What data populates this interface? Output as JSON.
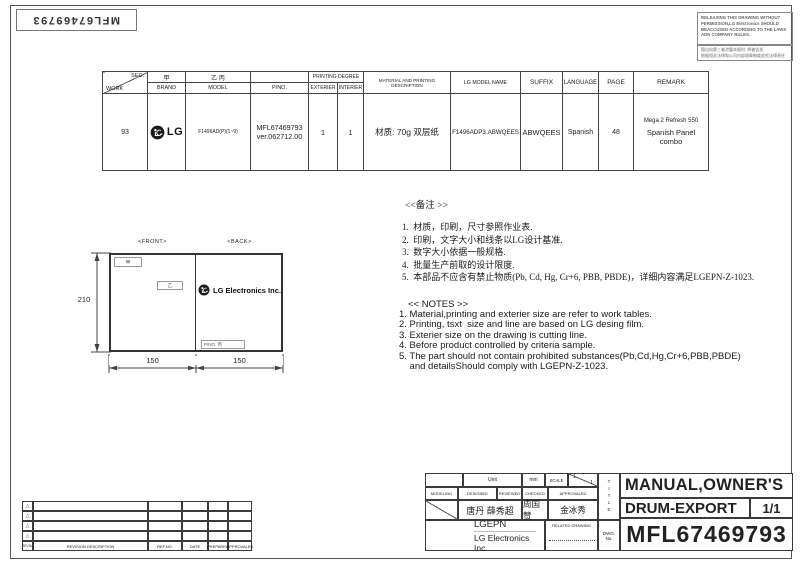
{
  "page": {
    "doc_number_rotated": "MFL67469793",
    "release_warning_en": "RELEASING THIS DRAWING WITHOUT PERMISSION,LG Electronics SHOULD BEACCUSED ACCORDING TO THE LAWS ADN COMPANY RULES.",
    "release_warning_cn_line1": "擅自向第三者泄露本图时, 将被告发.",
    "release_warning_cn_line2": "根据相关法律和公司内部规章制度追究法律责任"
  },
  "spec_table": {
    "header": {
      "sec": "SEC.",
      "work": "WORK",
      "jia": "甲",
      "brand": "BRAND",
      "yi_bing": "乙 丙",
      "model": "MODEL",
      "pno": "P/NO.",
      "printing_degree": "PRINTING DEGREE",
      "exterier": "EXTERIER",
      "interier": "INTERIER",
      "material": "MATERIAL AND PRINTING DESCRIPTION",
      "lg_model_name": "LG MODEL NAME",
      "suffix": "SUFFIX",
      "language": "LANGUAGE",
      "page": "PAGE",
      "remark": "REMARK"
    },
    "row": {
      "work": "93",
      "brand": "LG",
      "model": "F1496AD(P)(1~9)",
      "pno_line1": "MFL67469793",
      "pno_line2": "ver.062712.00",
      "exterier": "1",
      "interier": "1",
      "material": "材质: 70g 双层纸",
      "lg_model_name": "F1496ADP3.ABWQEES",
      "suffix": "ABWQEES",
      "language": "Spanish",
      "page": "48",
      "remark_line1": "Mega 2 Refresh 550",
      "remark_line2": "Spanish Panel combo"
    }
  },
  "diagram": {
    "front_label": "<FRONT>",
    "back_label": "<BACK>",
    "height_dim": "210",
    "width_dim_left": "150",
    "width_dim_right": "150",
    "jia_tag": "甲",
    "yi_tag": "乙",
    "pno_tag": "P/NO. 丙",
    "back_brand": "LG Electronics Inc."
  },
  "notes_cn": {
    "header": "<<备注 >>",
    "items": [
      "1.  材质，印刷，尺寸参照作业表.",
      "2.  印刷，文字大小和线条以LG设计基准.",
      "3.  数字大小依据一般规格.",
      "4.  批量生产前取的设计限度.",
      "5.  本部品不应含有禁止物质(Pb, Cd, Hg, Cr+6, PBB, PBDE)，详细内容满足LGEPN-Z-1023."
    ]
  },
  "notes_en": {
    "header": "<< NOTES >>",
    "items": [
      "1. Material,printing and exterier size are refer to work tables.",
      "2. Printing, tsxt  size and line are based on LG desing film.",
      "3. Exterier size on the drawing is cutting line.",
      "4. Before product controlled by criteria sample.",
      "5. The part should not contain prohibited substances(Pb,Cd,Hg,Cr+6,PBB,PBDE)"
    ],
    "item5_cont": "    and detailsShould comply with LGEPN-Z-1023."
  },
  "title_block": {
    "unit_label": "Unit",
    "unit_value": "mm",
    "scale_label": "SCALE",
    "scale_num": "1",
    "scale_den": "1",
    "modeling_label": "MODELING",
    "designed_label": "DESIGNED",
    "reviewed_label": "REVIEWED",
    "checked_label": "CHECKED",
    "approvaled_label": "APPROVALED",
    "designed_names": "唐丹 薛秀超",
    "checked_name": "周国赞",
    "approvaled_name": "金冰秀",
    "company_short": "LGEPN",
    "company_full": "LG Electronics Inc.",
    "related_drawing_label": "RELATED DRAWING",
    "title_label_vertical": "TITLE",
    "dwg_no_label": "DWG. No.",
    "title_line1": "MANUAL,OWNER'S",
    "title_line2": "DRUM-EXPORT",
    "sheet": "1/1",
    "dwg_no": "MFL67469793"
  },
  "revision_table": {
    "marker": "△",
    "headers": [
      "REV.No",
      "REVISION DESCRIPTION",
      "REF.NO.",
      "DATE",
      "PREPARED",
      "APPROVALED"
    ]
  }
}
